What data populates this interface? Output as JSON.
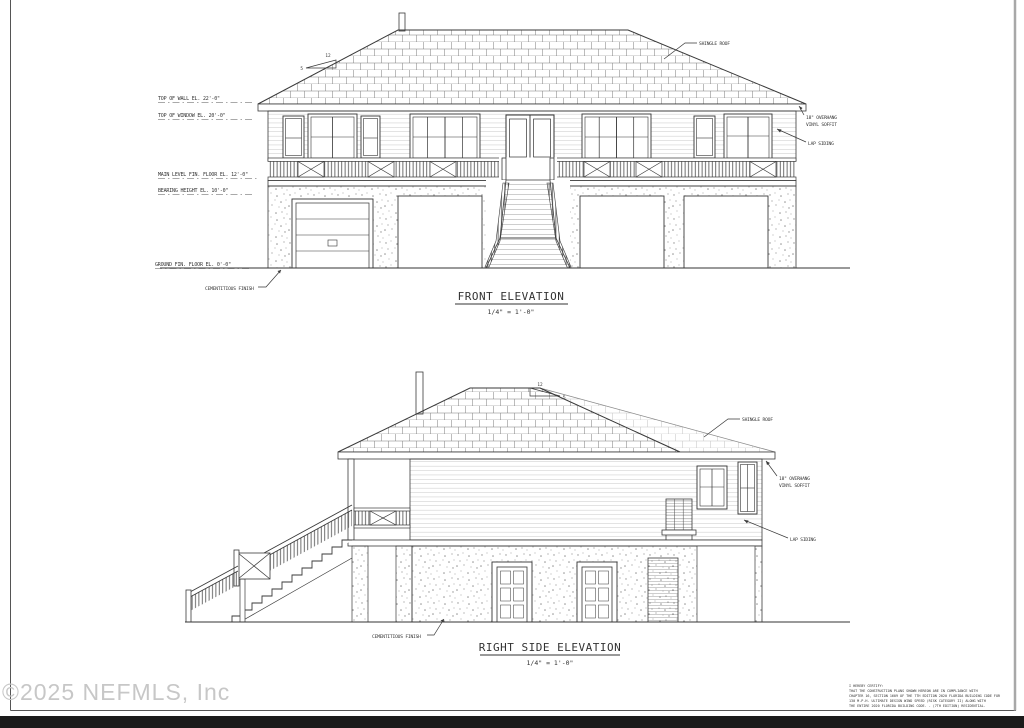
{
  "drawing": {
    "watermark": "©2025 NEFMLS, Inc",
    "front": {
      "title": "FRONT ELEVATION",
      "scale": "1/4\" = 1'-0\"",
      "pitch_run": "12",
      "pitch_rise": "5",
      "labels": {
        "top_of_wall": "TOP OF WALL EL. 22'-0\"",
        "top_of_window": "TOP OF WINDOW EL. 20'-0\"",
        "main_level": "MAIN LEVEL FIN. FLOOR EL. 12'-0\"",
        "bearing": "BEARING HEIGHT EL. 10'-0\"",
        "ground": "GROUND FIN. FLOOR EL. 0'-0\"",
        "shingle_roof": "SHINGLE ROOF",
        "overhang1": "18\" OVERHANG",
        "overhang2": "VINYL SOFFIT",
        "lap_siding": "LAP SIDING",
        "cementitious": "CEMENTITIOUS FINISH"
      }
    },
    "side": {
      "title": "RIGHT SIDE ELEVATION",
      "scale": "1/4\" = 1'-0\"",
      "pitch_run": "12",
      "pitch_rise": "5",
      "labels": {
        "shingle_roof": "SHINGLE ROOF",
        "overhang1": "18\" OVERHANG",
        "overhang2": "VINYL SOFFIT",
        "lap_siding": "LAP SIDING",
        "cementitious": "CEMENTITIOUS FINISH"
      }
    },
    "certification": {
      "lines": [
        "I HEREBY CERTIFY:",
        "THAT THE CONSTRUCTION PLANS SHOWN HEREON ARE IN COMPLIANCE WITH",
        "CHAPTER 16, SECTION 1609 OF THE 7TH EDITION 2020 FLORIDA BUILDING CODE FOR",
        "130 M.P.H. ULTIMATE DESIGN WIND SPEED (RISK CATEGORY II) ALONG WITH",
        "THE ENTIRE 2020 FLORIDA BUILDING CODE. - (7TH EDITION) RESIDENTIAL."
      ]
    }
  }
}
